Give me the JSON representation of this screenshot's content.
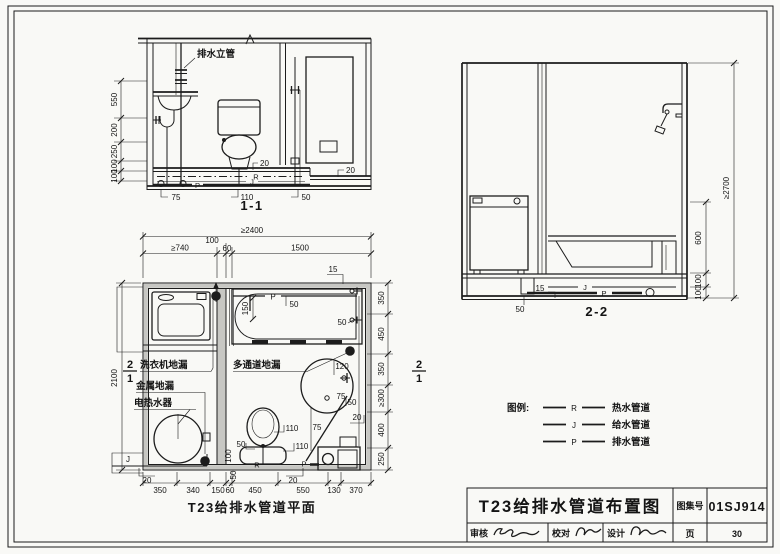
{
  "colors": {
    "ink": "#1c1c1c",
    "paper": "#f9f9f6",
    "wall_fill": "#c7c7c3"
  },
  "sec11": {
    "caption": "1-1",
    "riser_label": "排水立管",
    "dims_left": [
      "550",
      "200",
      "250",
      "100",
      "100"
    ],
    "dims_bottom": [
      "75",
      "110",
      "50"
    ],
    "dim_toilet": "20",
    "dim_right": "20",
    "lbl_r": "R",
    "lbl_j": "J",
    "lbl_p": "P"
  },
  "plan": {
    "caption": "T23给排水管道平面",
    "dim_top_total": "≥2400",
    "dims_top": [
      "≥740",
      "100",
      "60",
      "1500"
    ],
    "dim_left_total": "2100",
    "dims_right": [
      "350",
      "450",
      "350",
      "≥300",
      "400",
      "250"
    ],
    "dims_bottom": [
      "350",
      "340",
      "150",
      "60",
      "450",
      "550",
      "130",
      "370"
    ],
    "lbl_washer_drain": "洗衣机地漏",
    "lbl_multi_drain": "多通道地漏",
    "lbl_metal_drain": "金属地漏",
    "lbl_heater": "电热水器",
    "marker_num": "2",
    "marker_den": "1",
    "ann": {
      "tub_p": "P",
      "tub_50": "50",
      "tub_150": "150",
      "wall_15": "15",
      "wall_50": "50",
      "basin_120": "120",
      "basin_75": "75",
      "basin_50": "50",
      "basin_20": "20",
      "left_75": "75",
      "wc_110a": "110",
      "wc_110b": "110",
      "wc_50": "50",
      "wc_100": "100",
      "vert_50": "50",
      "pipe_r": "R",
      "pipe_p": "P",
      "pipe_j": "J",
      "j_20": "20",
      "wc_20": "20"
    }
  },
  "sec22": {
    "caption": "2-2",
    "dim_total": "≥2700",
    "dims_right": [
      "600",
      "100",
      "100"
    ],
    "ann": {
      "a15": "15",
      "a50": "50",
      "j": "J",
      "p": "P"
    }
  },
  "legend": {
    "title": "图例:",
    "items": [
      {
        "symbol": "R",
        "label": "热水管道"
      },
      {
        "symbol": "J",
        "label": "给水管道"
      },
      {
        "symbol": "P",
        "label": "排水管道"
      }
    ]
  },
  "title_block": {
    "title": "T23给排水管道布置图",
    "atlas_label": "图集号",
    "atlas_no": "01SJ914",
    "page_label": "页",
    "page_no": "30",
    "review": "审核",
    "proof": "校对",
    "design": "设计"
  }
}
